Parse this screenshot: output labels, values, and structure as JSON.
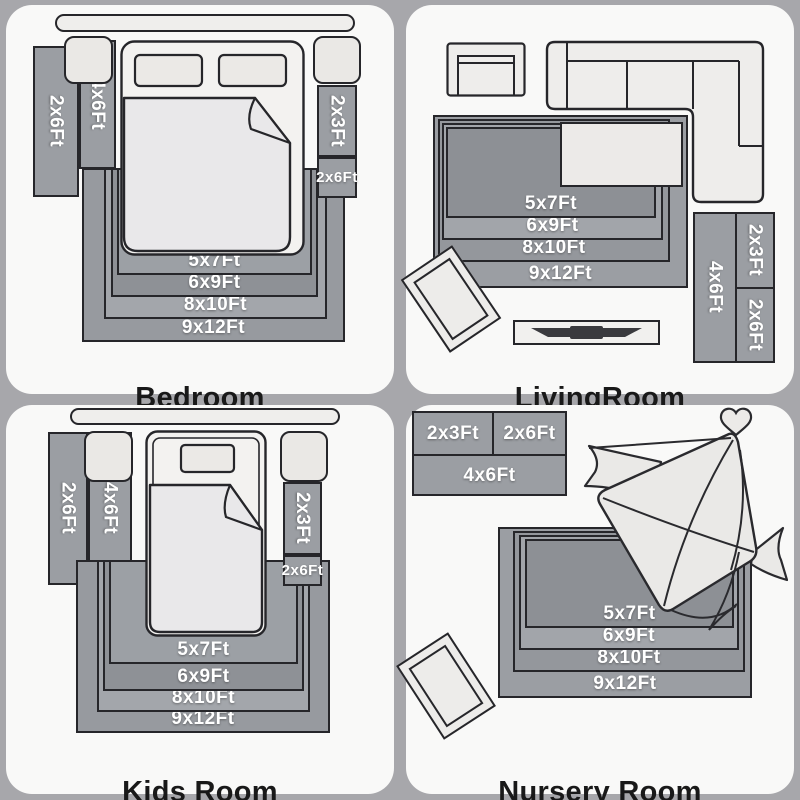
{
  "colors": {
    "page_bg": "#a7a7ab",
    "panel_bg": "#f9f9f8",
    "rug_gray": "#9b9ea3",
    "rug_dark": "#8d9095",
    "outline": "#26262a",
    "furniture_light": "#eeedeb",
    "label_text": "#ffffff",
    "title_text": "#191919"
  },
  "panels": {
    "bedroom": {
      "title": "Bedroom",
      "left_rugs": [
        "2x6Ft",
        "4x6Ft"
      ],
      "right_rugs": [
        "2x3Ft",
        "2x6Ft"
      ],
      "nested": [
        "5x7Ft",
        "6x9Ft",
        "8x10Ft",
        "9x12Ft"
      ]
    },
    "livingroom": {
      "title": "LivingRoom",
      "nested": [
        "5x7Ft",
        "6x9Ft",
        "8x10Ft",
        "9x12Ft"
      ],
      "side_group": {
        "tall": "4x6Ft",
        "top": "2x3Ft",
        "bottom": "2x6Ft"
      }
    },
    "kidsroom": {
      "title": "Kids Room",
      "left_rugs": [
        "2x6Ft",
        "4x6Ft"
      ],
      "right_rugs": [
        "2x3Ft",
        "2x6Ft"
      ],
      "nested": [
        "5x7Ft",
        "6x9Ft",
        "8x10Ft",
        "9x12Ft"
      ]
    },
    "nursery": {
      "title": "Nursery Room",
      "top_group": {
        "left": "2x3Ft",
        "right": "2x6Ft",
        "bottom": "4x6Ft"
      },
      "nested": [
        "5x7Ft",
        "6x9Ft",
        "8x10Ft",
        "9x12Ft"
      ]
    }
  }
}
